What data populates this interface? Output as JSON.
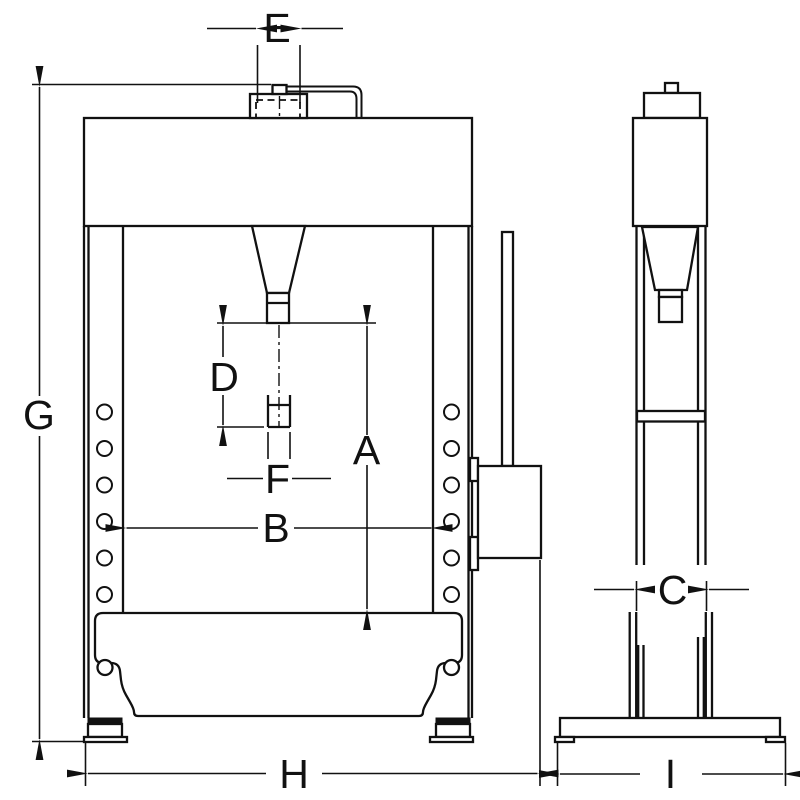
{
  "diagram": {
    "background_color": "#ffffff",
    "line_color": "#111111",
    "labels": {
      "A": "A",
      "B": "B",
      "C": "C",
      "D": "D",
      "E": "E",
      "F": "F",
      "G": "G",
      "H": "H",
      "I": "I"
    }
  }
}
